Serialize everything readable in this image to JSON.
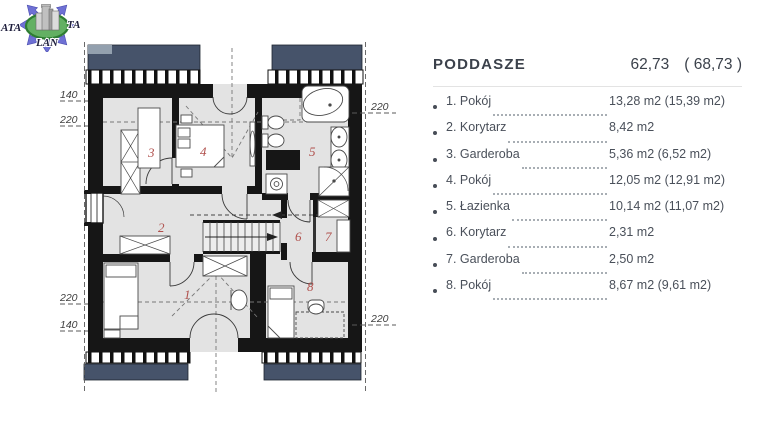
{
  "logo": {
    "word_left": "ATA",
    "word_right": "TA",
    "word_bottom": "LAN"
  },
  "panel": {
    "title": "PODDASZE",
    "area": "62,73",
    "area_alt": "( 68,73 )",
    "rooms": [
      {
        "label": "1. Pokój",
        "area": "13,28 m2 (15,39 m2)"
      },
      {
        "label": "2. Korytarz",
        "area": "8,42 m2"
      },
      {
        "label": "3. Garderoba",
        "area": "5,36 m2 (6,52 m2)"
      },
      {
        "label": "4. Pokój",
        "area": "12,05 m2 (12,91 m2)"
      },
      {
        "label": "5. Łazienka",
        "area": "10,14 m2 (11,07 m2)"
      },
      {
        "label": "6. Korytarz",
        "area": "2,31 m2"
      },
      {
        "label": "7. Garderoba",
        "area": "2,50 m2"
      },
      {
        "label": "8. Pokój",
        "area": "8,67 m2 (9,61 m2)"
      }
    ]
  },
  "plan": {
    "labels": {
      "room1": "1",
      "room2": "2",
      "room3": "3",
      "room4": "4",
      "room5": "5",
      "room6": "6",
      "room7": "7",
      "room8": "8"
    },
    "dims": {
      "left_top_140": "140",
      "left_top_220": "220",
      "left_bottom_220": "220",
      "left_bottom_140": "140",
      "right_top_220": "220",
      "right_bottom_220": "220"
    },
    "colors": {
      "wall": "#161616",
      "room_fill": "#e3e3e3",
      "accent_red": "#b0504c",
      "roof_slate": "#46536a",
      "logo_arrow": "#6e70d4",
      "logo_green": "#63b063"
    }
  }
}
